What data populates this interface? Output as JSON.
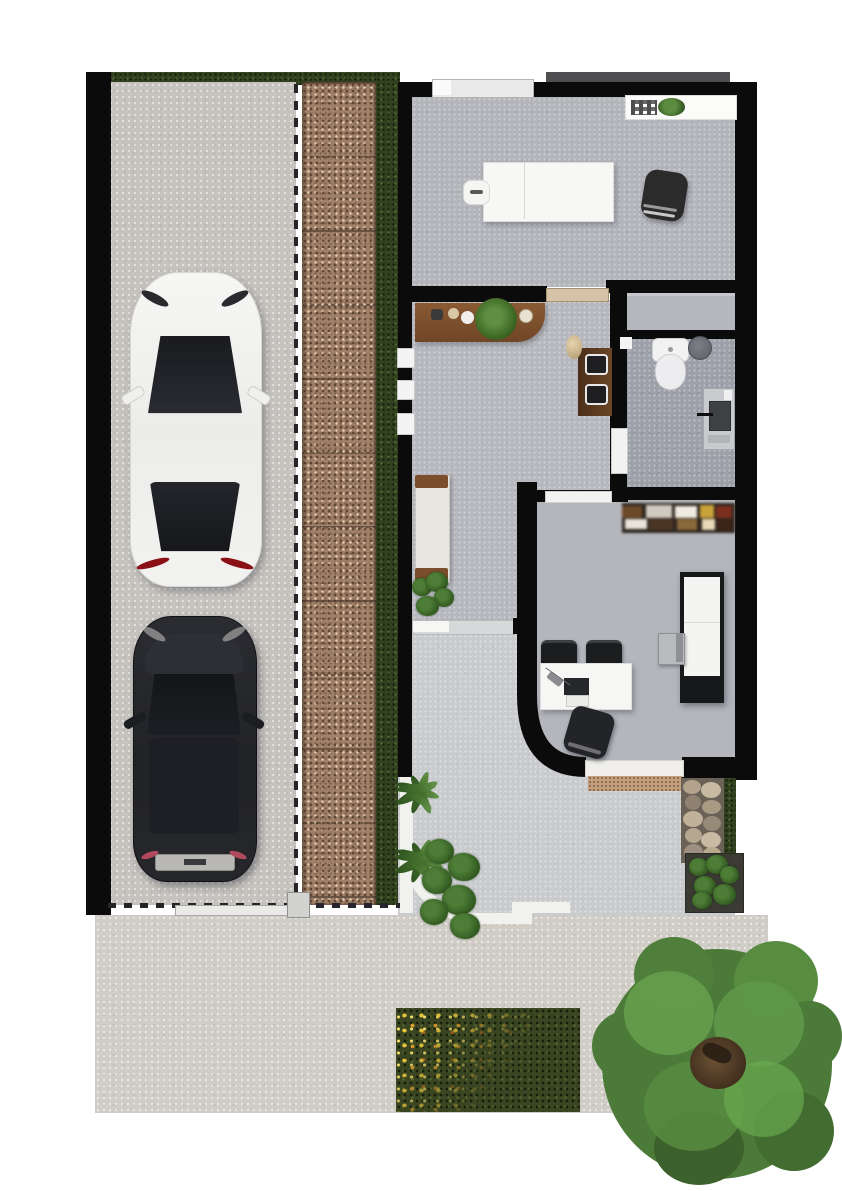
{
  "meta": {
    "scene": "residential-floor-plan-top-view-render",
    "canvas": {
      "width": 842,
      "height": 1191
    }
  },
  "palette": {
    "background": "#ffffff",
    "wall": "#0b0b0b",
    "roof_edge": "#4f4f51",
    "interior_floor": "#b5b7bd",
    "bathroom_floor": "#9da0a8",
    "driveway_concrete": "#c6c3be",
    "sidewalk_concrete": "#d0cdc6",
    "gravel_pavers": "#a08068",
    "grass_strip": "#32411f",
    "lawn": "#3a4521",
    "patio": "#c9cbce",
    "wood": "#7b4f2c",
    "door_wood": "#d5c3a8",
    "tree_green": "#4c7a39",
    "leaf_yellow": "#e8c43c",
    "car_white": "#f2f2f1",
    "car_black": "#232428",
    "furniture_white": "#f5f5f4",
    "chair_black": "#26262a"
  },
  "site": {
    "driveway": {
      "label": "driveway",
      "vehicles": [
        "white-sedan-top-view",
        "black-suv-top-view"
      ],
      "boundary": "black-perimeter-wall",
      "fence": "dashed-line-fence",
      "gate": "sliding-gate-with-post"
    },
    "landscape": {
      "items": [
        "gravel-paver-strip",
        "grass-strips",
        "autumn-lawn-with-fallen-leaves",
        "large-round-tree",
        "palm-shrubs",
        "monstera-plants",
        "stone-feature",
        "hedge",
        "planter-box"
      ]
    },
    "outdoor": {
      "items": [
        "curved-patio",
        "white-curb-path",
        "entrance-doormat",
        "public-sidewalk"
      ]
    }
  },
  "rooms": [
    {
      "id": "treatment-room",
      "label": "treatment room",
      "furniture": [
        "massage-table-with-headrest",
        "office-chair",
        "counter-with-plants",
        "top-window"
      ]
    },
    {
      "id": "hallway-lounge",
      "label": "hallway lounge",
      "furniture": [
        "wood-console-with-plants",
        "wall-shelf-with-decor",
        "bench-daybed",
        "floor-plant",
        "side-windows",
        "glass-sliding-door"
      ]
    },
    {
      "id": "bathroom",
      "label": "bathroom",
      "furniture": [
        "toilet",
        "round-sink",
        "washing-machine",
        "closet-band"
      ]
    },
    {
      "id": "dining-kitchen",
      "label": "dining kitchen",
      "furniture": [
        "pantry-shelf",
        "kitchen-island",
        "dining-table",
        "dining-chairs",
        "low-stool",
        "laptop-on-table",
        "curved-wall",
        "entry-door-threshold"
      ]
    }
  ]
}
